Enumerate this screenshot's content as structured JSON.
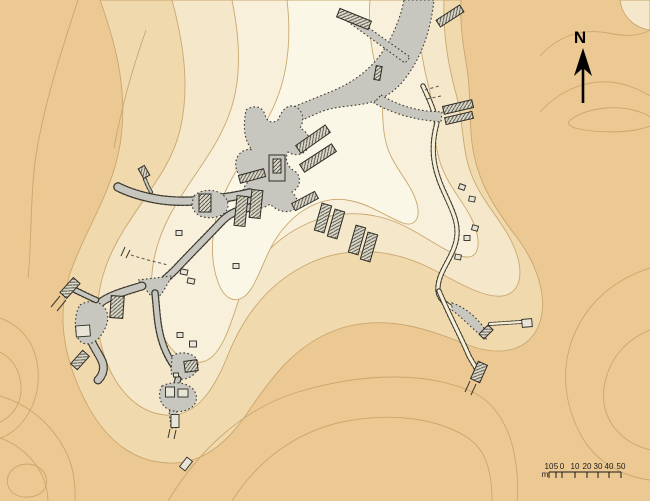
{
  "map": {
    "kind": "topographic-site-plan",
    "north": {
      "label": "N"
    },
    "scalebar": {
      "unit": "m",
      "labels": [
        "10",
        "5",
        "0",
        "10",
        "20",
        "30",
        "40",
        "50"
      ]
    },
    "palette": {
      "terrain_base": "#ecc893",
      "terrain_band2": "#f1d9ae",
      "terrain_band3": "#f5e7c9",
      "terrain_band4": "#f8f0da",
      "terrain_core": "#fbf7e7",
      "contour_line": "#c9a76e",
      "excavated_gray": "#c8c7bf",
      "structure_fill": "#dcd9c8",
      "outline_dark": "#2e2b26",
      "arrow_black": "#000000"
    }
  }
}
